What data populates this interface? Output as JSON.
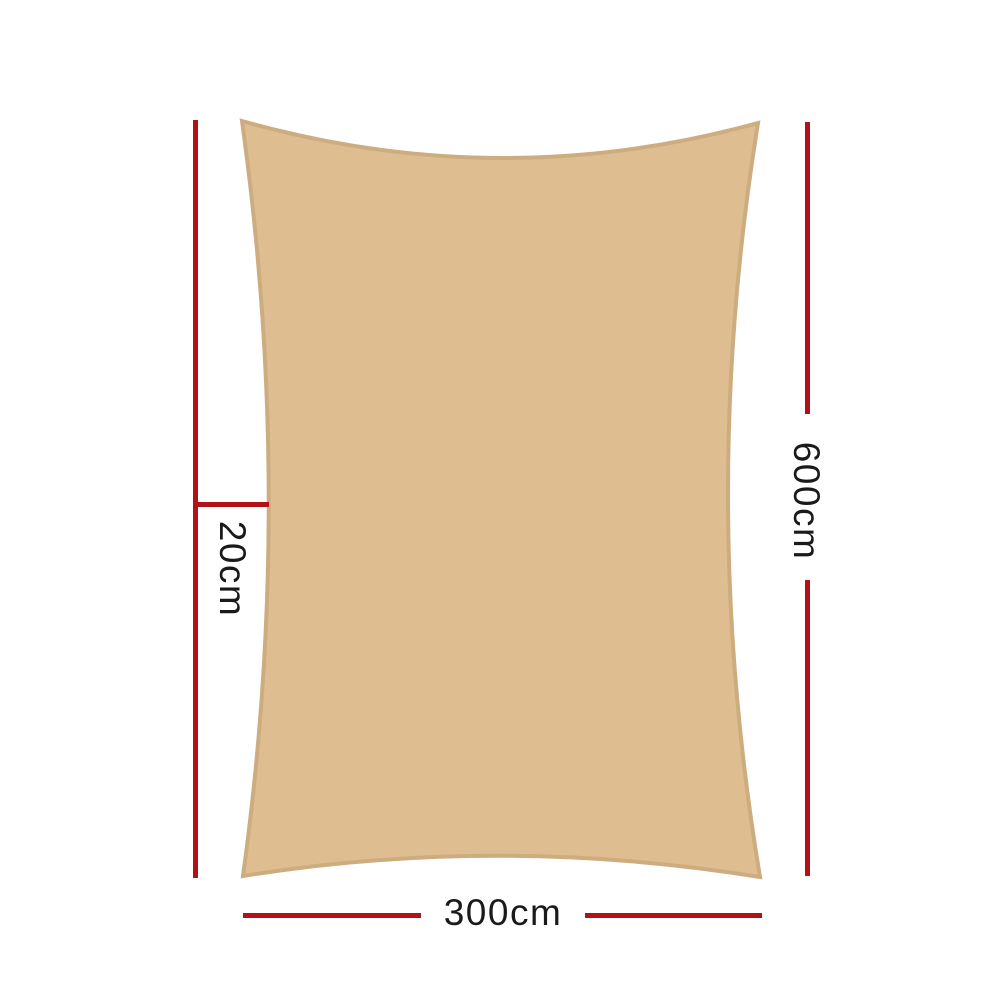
{
  "diagram": {
    "type": "product-dimension-diagram",
    "subject": "rectangle shade sail top view",
    "labels": {
      "width": "300cm",
      "height": "600cm",
      "curve_depth": "20cm"
    },
    "dimensions": {
      "width_cm": 300,
      "height_cm": 600,
      "edge_curve_depth_cm": 20
    },
    "colors": {
      "background": "#FFFFFF",
      "sail_fill": "#DEBE90",
      "sail_border": "#CDAC80",
      "dimension_line": "#B01217",
      "label_text": "#1A1A1A"
    }
  }
}
